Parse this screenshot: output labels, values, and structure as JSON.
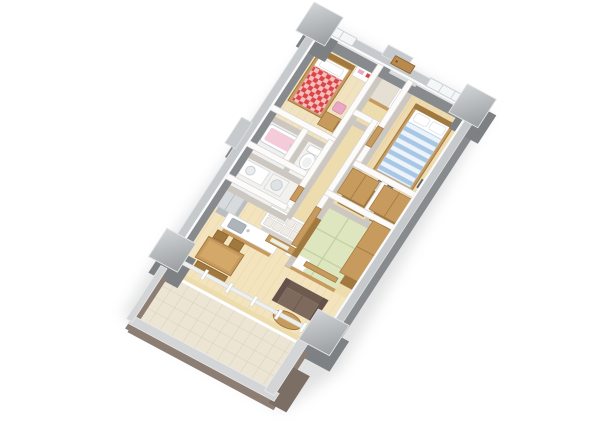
{
  "meta": {
    "description": "3D isometric cutaway render of a 3LDK apartment floor plan, rotated ~30 degrees, on white background",
    "render_type": "architectural-dollhouse-view"
  },
  "colors": {
    "bg": "#ffffff",
    "shadowColor": "#7a7d80",
    "outerWallFace": "#888b8e",
    "outerWallCap": "#c7cacc",
    "pillarFace": "#7d8184",
    "pillarCapA": "#d2d5d7",
    "pillarCapB": "#999da0",
    "innerWallFace": "#ccc8c1",
    "innerWallCap": "#fcfbf9",
    "wood": "#c79a5e",
    "woodDark": "#a1783e",
    "woodDoor": "#b98a4e",
    "floorBedroom2": "#f1e3c0",
    "floorMaster": "#eedaaf",
    "floorHall": "#ecdcae",
    "floorLDK": "#f3e4bd",
    "genkan": "#e6dfd3",
    "tatami": "#dde6bf",
    "tatamiLine": "#c3cfa0",
    "bathFloor": "#eef0f2",
    "toiletFloor": "#f4f2ef",
    "washFloor": "#f2f1ee",
    "white": "#ffffff",
    "tubPink": "#f3cbd9",
    "stoolPink": "#eaa9c3",
    "bedRed": "#dc4545",
    "bedBlueLight": "#edf3fa",
    "bedBlueStripe": "#a7c7e5",
    "sofaBack": "#6e5a4f",
    "sofaSeat": "#7e695d",
    "sofaArm": "#64524a",
    "fridge": "#d8dbdd",
    "fridgeSide": "#b9bec2",
    "steel": "#c2c7cb",
    "sinkInner": "#aeb5ba",
    "balconyTile": "#ece5d4",
    "balconyTileLine": "#d9d0be",
    "balconyWall": "#8d7e74",
    "balconyWallDark": "#7b6e65",
    "parapetCap": "#d3d5d6",
    "glassSill": "#eef0ee",
    "darkItem": "#5d646c"
  },
  "scene": {
    "rooms": [
      {
        "name": "bedroom-2",
        "floor": "light wood"
      },
      {
        "name": "entrance-hall",
        "floor": "stone tile"
      },
      {
        "name": "master-bedroom",
        "floor": "light wood"
      },
      {
        "name": "corridor",
        "floor": "wood"
      },
      {
        "name": "bathroom",
        "floor": "white tile"
      },
      {
        "name": "toilet",
        "floor": "white tile"
      },
      {
        "name": "washroom",
        "floor": "white tile"
      },
      {
        "name": "walk-in-closet",
        "floor": "wood"
      },
      {
        "name": "closet",
        "floor": "wood"
      },
      {
        "name": "tatami-room",
        "floor": "green tatami mats"
      },
      {
        "name": "living-dining-kitchen",
        "floor": "light wood"
      },
      {
        "name": "balcony",
        "floor": "beige tile grid"
      }
    ],
    "furniture": [
      {
        "name": "kids-bed",
        "detail": "red-white gingham duvet"
      },
      {
        "name": "double-bed",
        "detail": "blue striped duvet, two pillows"
      },
      {
        "name": "study-desk"
      },
      {
        "name": "pink-stool"
      },
      {
        "name": "dresser"
      },
      {
        "name": "bathtub",
        "detail": "pink"
      },
      {
        "name": "toilet-bowl"
      },
      {
        "name": "vanity-basin"
      },
      {
        "name": "washing-machine"
      },
      {
        "name": "refrigerator"
      },
      {
        "name": "kitchen-counter-with-sink"
      },
      {
        "name": "drawer-cupboard"
      },
      {
        "name": "dining-table"
      },
      {
        "name": "dining-chairs",
        "count": 2
      },
      {
        "name": "dining-bench"
      },
      {
        "name": "sofa",
        "detail": "brown two-seater"
      },
      {
        "name": "oval-coffee-table"
      },
      {
        "name": "floor-cushion"
      }
    ],
    "structure": [
      {
        "name": "corner-pillars",
        "count": 4
      },
      {
        "name": "outer-concrete-walls"
      },
      {
        "name": "balcony-parapet"
      },
      {
        "name": "glass-sliding-wall"
      }
    ]
  }
}
